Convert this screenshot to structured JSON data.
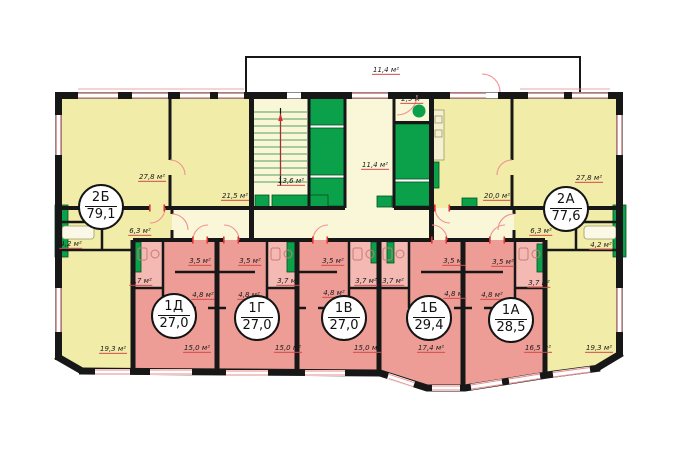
{
  "plan": {
    "units": "м²",
    "colors": {
      "room_yellow": "#f1eda8",
      "common_pale": "#faf7d8",
      "apartment_pink": "#ee9d96",
      "bath_pink": "#f3b9b2",
      "shaft_green": "#0ba14a",
      "wall_black": "#171717",
      "door_red": "#e04040"
    },
    "apartments": [
      {
        "id": "2Б",
        "total": "79,1",
        "rooms": {
          "living": "27,8 м²",
          "kitchen": "21,5 м²",
          "bedroom": "19,3 м²",
          "hall": "6,3 м²",
          "bath": "4,2 м²"
        }
      },
      {
        "id": "2А",
        "total": "77,6",
        "rooms": {
          "living": "27,8 м²",
          "kitchen": "20,0 м²",
          "bedroom": "19,3 м²",
          "hall": "6,3 м²",
          "bath": "4,2 м²"
        }
      },
      {
        "id": "1Д",
        "total": "27,0",
        "rooms": {
          "kitchen": "3,5 м²",
          "bath": "3,7 м²",
          "hall": "4,8 м²",
          "living": "15,0 м²"
        }
      },
      {
        "id": "1Г",
        "total": "27,0",
        "rooms": {
          "kitchen": "3,5 м²",
          "bath": "3,7 м²",
          "hall": "4,8 м²",
          "living": "15,0 м²"
        }
      },
      {
        "id": "1В",
        "total": "27,0",
        "rooms": {
          "kitchen": "3,5 м²",
          "bath": "3,7 м²",
          "hall": "4,8 м²",
          "living": "15,0 м²"
        }
      },
      {
        "id": "1Б",
        "total": "29,4",
        "rooms": {
          "kitchen": "3,5 м²",
          "bath": "3,7 м²",
          "hall": "4,8 м²",
          "living": "17,4 м²"
        }
      },
      {
        "id": "1А",
        "total": "28,5",
        "rooms": {
          "kitchen": "3,5 м²",
          "bath": "3,7 м²",
          "hall": "4,8 м²",
          "living": "16,5 м²"
        }
      }
    ],
    "common": {
      "balcony": "11,4 м²",
      "stairs": "13,6 м²",
      "lobby": "11,4 м²",
      "vestibule": "2,9 м²"
    }
  }
}
